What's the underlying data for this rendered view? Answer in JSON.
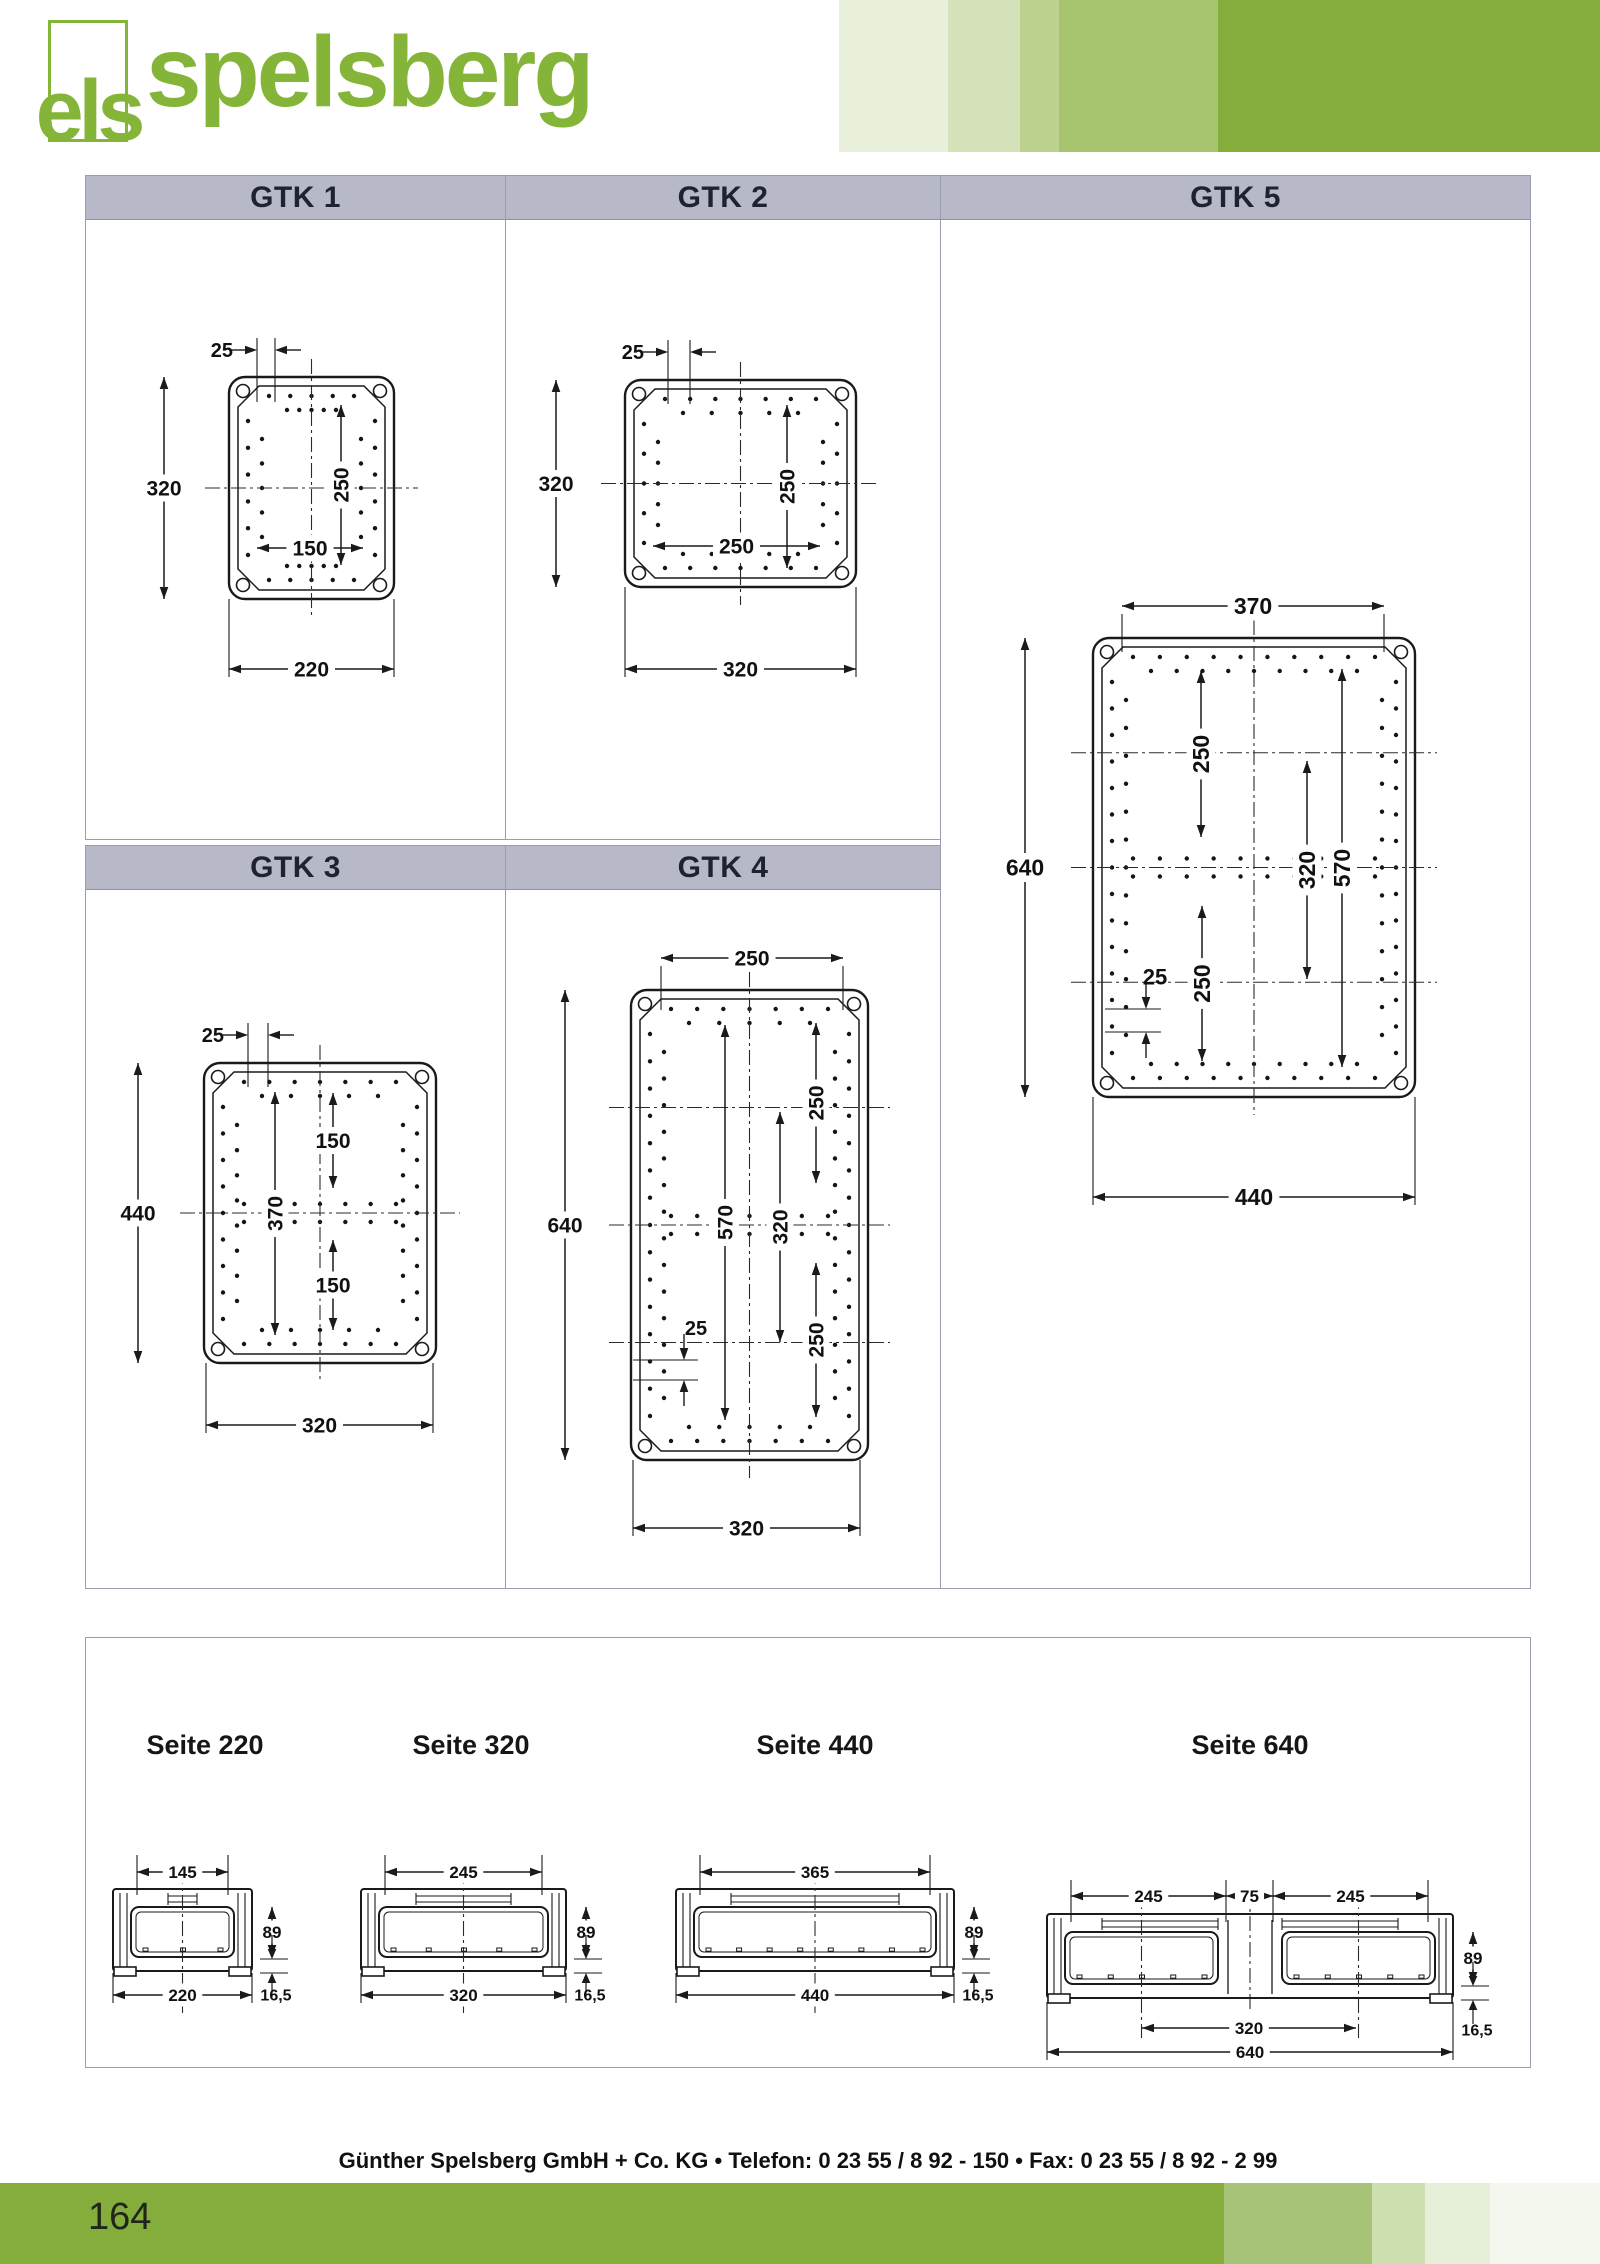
{
  "logo": {
    "mark": "els",
    "word": "spelsberg"
  },
  "panels": [
    {
      "id": "gtk1",
      "title": "GTK 1",
      "dims": [
        "25",
        "320",
        "250",
        "150",
        "220"
      ]
    },
    {
      "id": "gtk2",
      "title": "GTK 2",
      "dims": [
        "25",
        "320",
        "250",
        "250",
        "320"
      ]
    },
    {
      "id": "gtk3",
      "title": "GTK 3",
      "dims": [
        "25",
        "440",
        "370",
        "150",
        "150",
        "320"
      ]
    },
    {
      "id": "gtk4",
      "title": "GTK 4",
      "dims": [
        "250",
        "640",
        "250",
        "570",
        "320",
        "25",
        "250",
        "320"
      ]
    },
    {
      "id": "gtk5",
      "title": "GTK 5",
      "dims": [
        "370",
        "640",
        "250",
        "320",
        "570",
        "25",
        "250",
        "440"
      ]
    }
  ],
  "seite_panels": [
    {
      "title": "Seite 220",
      "dims": [
        "145",
        "89",
        "220",
        "16,5"
      ]
    },
    {
      "title": "Seite 320",
      "dims": [
        "245",
        "89",
        "320",
        "16,5"
      ]
    },
    {
      "title": "Seite 440",
      "dims": [
        "365",
        "89",
        "440",
        "16,5"
      ]
    },
    {
      "title": "Seite 640",
      "dims": [
        "245",
        "75",
        "245",
        "89",
        "320",
        "640",
        "16,5"
      ]
    }
  ],
  "footer": {
    "company_line": "Günther Spelsberg GmbH + Co. KG • Telefon: 0 23 55 / 8 92 - 150 • Fax: 0 23 55 / 8 92 - 2 99",
    "page_number": "164"
  },
  "colors": {
    "brand_green": "#84b438",
    "header_bar_gray": "#b7b9c9",
    "green_tints": [
      "#e9f0dc",
      "#d6e3ba",
      "#bdd28e",
      "#a5c46d",
      "#84ad3c"
    ],
    "footer_green": "#84ad3c",
    "footer_tints": [
      "#a6c377",
      "#cddfae",
      "#e6efd8",
      "#f3f7ed"
    ]
  }
}
